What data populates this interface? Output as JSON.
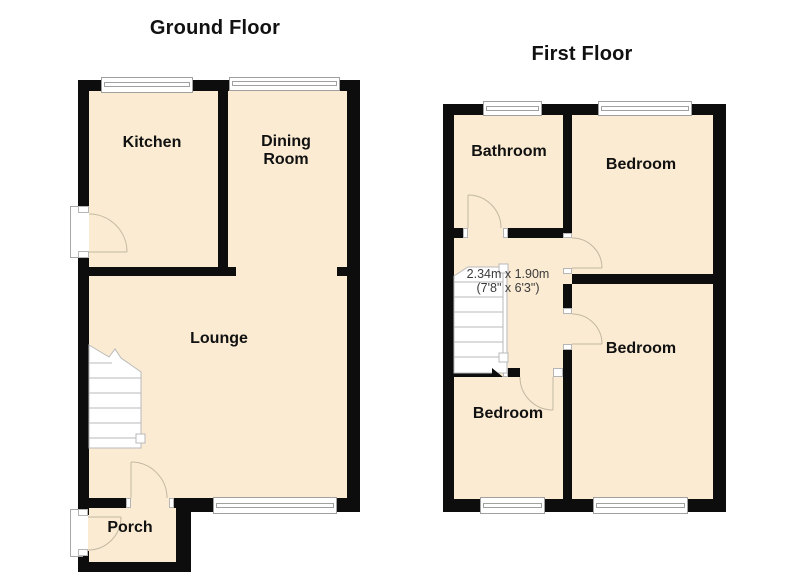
{
  "plan_title": "Floor plan",
  "colors": {
    "floor_fill": "#FAEBD2",
    "wall": "#0d0d0d",
    "door_arc": "#c3b8a3",
    "stair_line": "#b9b9b9",
    "window_line": "#a0a0a0",
    "label_text": "#111111",
    "dimension_text": "#3b3b3b",
    "background": "#ffffff"
  },
  "ground_floor": {
    "title": "Ground Floor",
    "rooms": [
      {
        "label": "Kitchen"
      },
      {
        "label": "Dining Room"
      },
      {
        "label": "Lounge"
      },
      {
        "label": "Porch"
      }
    ]
  },
  "first_floor": {
    "title": "First Floor",
    "rooms": [
      {
        "label": "Bathroom"
      },
      {
        "label": "Bedroom"
      },
      {
        "label": "Bedroom"
      },
      {
        "label": "Bedroom"
      }
    ],
    "dimension": {
      "metric": "2.34m x 1.90m",
      "imperial": "(7'8\" x 6'3\")"
    }
  }
}
